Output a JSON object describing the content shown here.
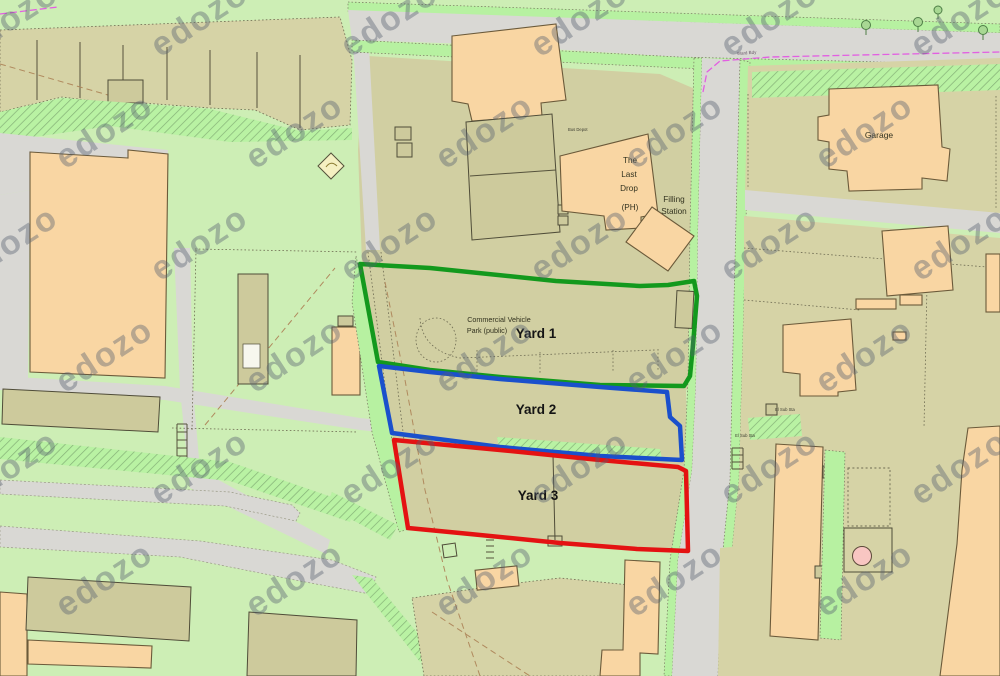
{
  "map": {
    "description": "OS-style site plan with three outlined yards",
    "labels": {
      "yard1": "Yard 1",
      "yard2": "Yard 2",
      "yard3": "Yard 3",
      "commercial_vehicle_park_line1": "Commercial Vehicle",
      "commercial_vehicle_park_line2": "Park (public)",
      "the_last_drop_line1": "The",
      "the_last_drop_line2": "Last",
      "the_last_drop_line3": "Drop",
      "the_last_drop_line4": "(PH)",
      "filling_station_line1": "Filling",
      "filling_station_line2": "Station",
      "garage": "Garage",
      "ward_boundary": "Ward Bdy",
      "el_sub_sta_1": "El Sub Sta",
      "el_sub_sta_2": "El Sub Sta",
      "bus_depot": "Bus Depot"
    },
    "site_outlines": [
      {
        "name": "Yard 1",
        "color": "#13991d"
      },
      {
        "name": "Yard 2",
        "color": "#1a50cc"
      },
      {
        "name": "Yard 3",
        "color": "#e41212"
      }
    ],
    "ward_boundary_color": "#e25fe2",
    "watermark": {
      "text": "edozo",
      "color": "#566070",
      "opacity": 0.4
    }
  }
}
